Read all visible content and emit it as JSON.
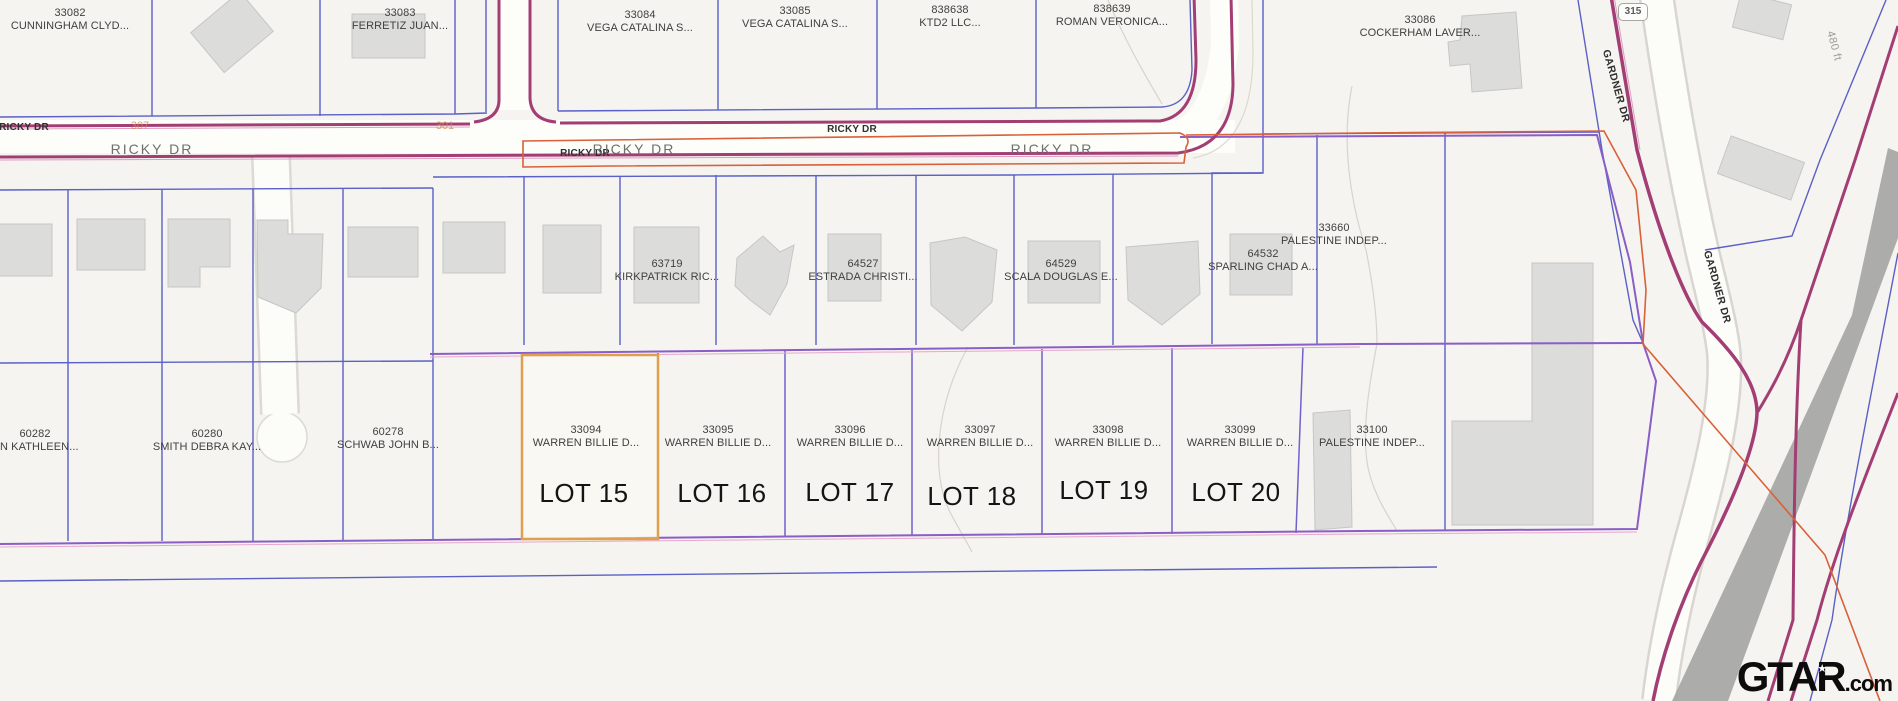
{
  "parcels": {
    "top": [
      {
        "id": "33082",
        "owner": "CUNNINGHAM CLYD..."
      },
      {
        "id": "33083",
        "owner": "FERRETIZ JUAN..."
      },
      {
        "id": "33084",
        "owner": "VEGA CATALINA S..."
      },
      {
        "id": "33085",
        "owner": "VEGA CATALINA S..."
      },
      {
        "id": "838638",
        "owner": "KTD2 LLC..."
      },
      {
        "id": "838639",
        "owner": "ROMAN VERONICA..."
      },
      {
        "id": "33086",
        "owner": "COCKERHAM LAVER..."
      }
    ],
    "middle": [
      {
        "id": "63719",
        "owner": "KIRKPATRICK RIC..."
      },
      {
        "id": "64527",
        "owner": "ESTRADA CHRISTI..."
      },
      {
        "id": "64529",
        "owner": "SCALA DOUGLAS E..."
      },
      {
        "id": "64532",
        "owner": "SPARLING CHAD A..."
      },
      {
        "id": "33660",
        "owner": "PALESTINE INDEP..."
      }
    ],
    "bottom": [
      {
        "id": "60282",
        "owner": "ON KATHLEEN..."
      },
      {
        "id": "60280",
        "owner": "SMITH DEBRA KAY..."
      },
      {
        "id": "60278",
        "owner": "SCHWAB JOHN B..."
      }
    ],
    "lots": [
      {
        "id": "33094",
        "owner": "WARREN BILLIE D...",
        "lot": "LOT 15"
      },
      {
        "id": "33095",
        "owner": "WARREN BILLIE D...",
        "lot": "LOT 16"
      },
      {
        "id": "33096",
        "owner": "WARREN BILLIE D...",
        "lot": "LOT 17"
      },
      {
        "id": "33097",
        "owner": "WARREN BILLIE D...",
        "lot": "LOT 18"
      },
      {
        "id": "33098",
        "owner": "WARREN BILLIE D...",
        "lot": "LOT 19"
      },
      {
        "id": "33099",
        "owner": "WARREN BILLIE D...",
        "lot": "LOT 20"
      },
      {
        "id": "33100",
        "owner": "PALESTINE INDEP..."
      }
    ]
  },
  "streets": {
    "ricky_dr": "RICKY DR",
    "gardner_dr": "GARDNER DR",
    "route_shield": "315",
    "distance_label": "480 ft",
    "ref_307": "307",
    "ref_301": "301"
  },
  "colors": {
    "parcel_line_blue": "#5a60c6",
    "boundary_purple": "#8a5ec6",
    "road_maroon": "#a33e75",
    "highlight_orange": "#dfa04e",
    "district_red": "#d96038",
    "building_gray": "#dcdcda"
  },
  "watermark": {
    "brand_gta": "GTA",
    "brand_r": "R",
    "star": "★",
    "tld": ".com"
  }
}
